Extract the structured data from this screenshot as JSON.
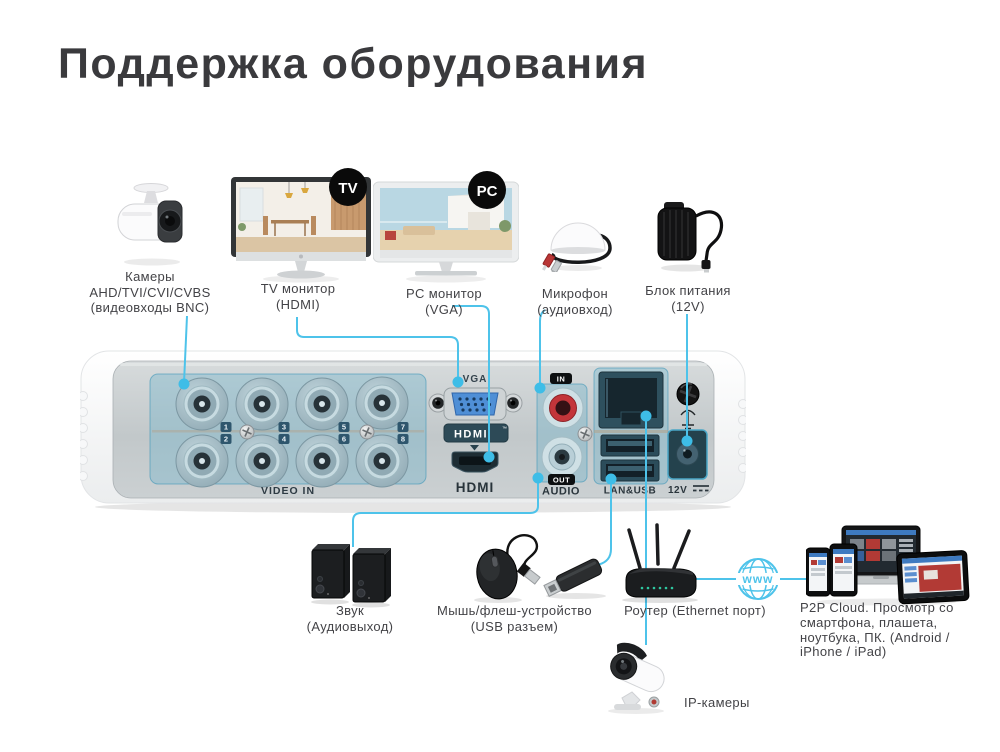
{
  "title": "Поддержка оборудования",
  "accent_color": "#4ec3ea",
  "top_row": {
    "cameras": {
      "line1": "Камеры",
      "line2": "AHD/TVI/CVI/CVBS",
      "line3": "(видеовходы BNC)"
    },
    "tv_monitor": {
      "badge": "TV",
      "line1": "TV монитор",
      "line2": "(HDMI)"
    },
    "pc_monitor": {
      "badge": "PC",
      "line1": "PC монитор",
      "line2": "(VGA)"
    },
    "microphone": {
      "line1": "Микрофон",
      "line2": "(аудиовход)"
    },
    "power_supply": {
      "line1": "Блок питания",
      "line2": "(12V)"
    }
  },
  "panel": {
    "video_in_label": "VIDEO IN",
    "vga_label": "VGA",
    "hdmi_logo": "HDMI",
    "hdmi_logo_tm": "™",
    "hdmi_label": "HDMI",
    "audio_in_badge": "IN",
    "audio_out_badge": "OUT",
    "audio_label": "AUDIO",
    "lan_usb_label": "LAN&USB",
    "power_label": "12V",
    "bnc_numbers": [
      "1",
      "2",
      "3",
      "4",
      "5",
      "6",
      "7",
      "8"
    ]
  },
  "bottom_row": {
    "speakers": {
      "line1": "Звук",
      "line2": "(Аудиовыход)"
    },
    "usb_devices": {
      "line1": "Мышь/флеш-устройство",
      "line2": "(USB разъем)"
    },
    "router": {
      "label": "Роутер (Ethernet порт)"
    },
    "www_globe": {
      "label": "www"
    },
    "p2p": {
      "line1": "P2P Cloud. Просмотр со",
      "line2": "смартфона, плашета,",
      "line3": "ноутбука, ПК. (Android /",
      "line4": "iPhone / iPad)"
    },
    "ip_cameras": {
      "label": "IP-камеры"
    }
  }
}
